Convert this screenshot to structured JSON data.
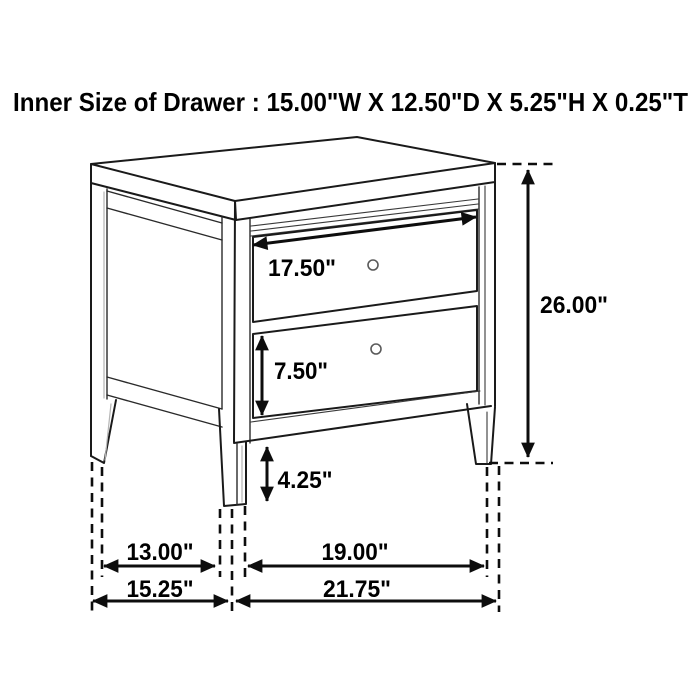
{
  "title": "Inner Size of Drawer : 15.00\"W X 12.50\"D X 5.25\"H X 0.25\"T",
  "diagram": {
    "kind": "furniture-dimension-drawing",
    "product": "2-drawer nightstand",
    "line_color": "#1a1a1a",
    "background": "#ffffff",
    "labels": {
      "top_drawer_width": "17.50\"",
      "overall_height": "26.00\"",
      "bottom_drawer_height": "7.50\"",
      "base_clearance": "4.25\"",
      "side_inner_depth": "13.00\"",
      "front_inner_width": "19.00\"",
      "side_overall_depth": "15.25\"",
      "front_overall_width": "21.75\""
    }
  }
}
